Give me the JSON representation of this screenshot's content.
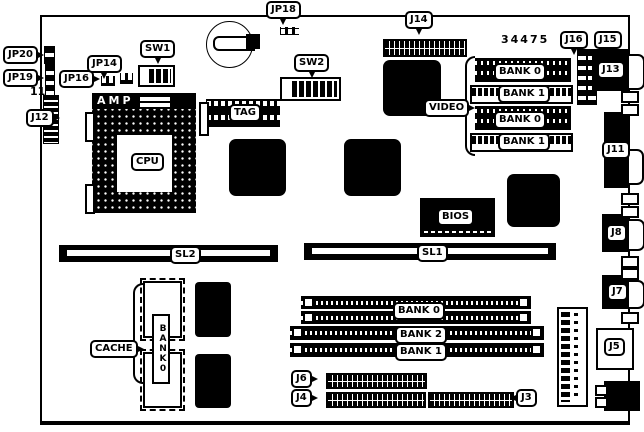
{
  "board": {
    "part_number": "34475",
    "pin1_label": "11"
  },
  "labels": {
    "jp20": "JP20",
    "jp19": "JP19",
    "j12": "J12",
    "jp16": "JP16",
    "jp14": "JP14",
    "sw1": "SW1",
    "jp18": "JP18",
    "sw2": "SW2",
    "j14": "J14",
    "j16": "J16",
    "j15": "J15",
    "j13": "J13",
    "j11": "J11",
    "j8": "J8",
    "j7": "J7",
    "j5": "J5",
    "j6": "J6",
    "j4": "J4",
    "j3": "J3",
    "amp": "AMP",
    "cpu": "CPU",
    "tag": "TAG",
    "video": "VIDEO",
    "bios": "BIOS",
    "cache": "CACHE",
    "sl2": "SL2",
    "sl1": "SL1"
  },
  "video_memory": {
    "banks": [
      "BANK 0",
      "BANK 1",
      "BANK 0",
      "BANK 1"
    ]
  },
  "main_memory": {
    "banks": [
      "BANK 0",
      "BANK 2",
      "BANK 1"
    ]
  },
  "cache_bank": "BANK0"
}
